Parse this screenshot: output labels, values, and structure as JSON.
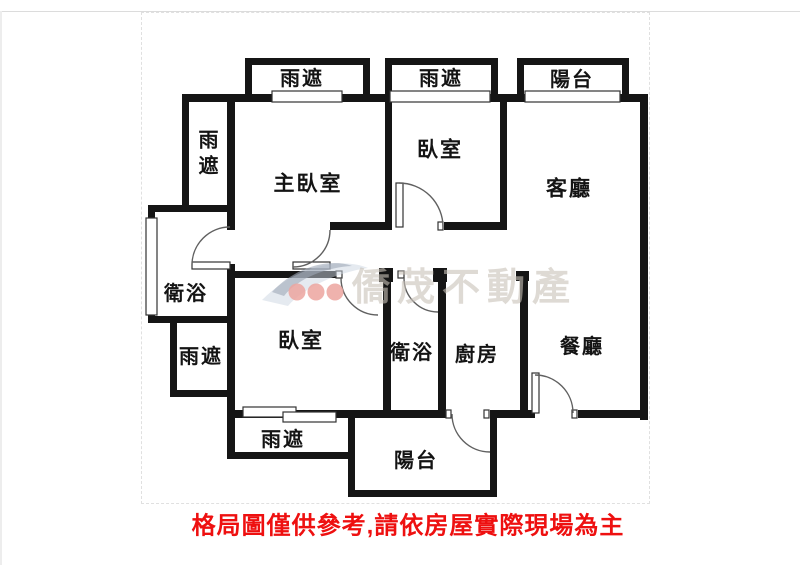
{
  "rooms": {
    "canopy_top_left": {
      "label": "雨遮"
    },
    "canopy_top_mid": {
      "label": "雨遮"
    },
    "balcony_top": {
      "label": "陽台"
    },
    "canopy_left_upper": {
      "label": "雨遮"
    },
    "master_bedroom": {
      "label": "主臥室"
    },
    "bedroom_top": {
      "label": "臥室"
    },
    "living_room": {
      "label": "客廳"
    },
    "bathroom_left": {
      "label": "衛浴"
    },
    "canopy_left_lower": {
      "label": "雨遮"
    },
    "bedroom_center": {
      "label": "臥室"
    },
    "bathroom_center": {
      "label": "衛浴"
    },
    "kitchen": {
      "label": "廚房"
    },
    "dining_room": {
      "label": "餐廳"
    },
    "canopy_bottom": {
      "label": "雨遮"
    },
    "balcony_bottom": {
      "label": "陽台"
    }
  },
  "watermark": {
    "brand": "僑茂不動產"
  },
  "disclaimer": {
    "text": "格局圖僅供參考,請依房屋實際現場為主"
  },
  "colors": {
    "wall": "#151515",
    "disclaimer_red": "#ee1010",
    "watermark_gray": "#c9c2b9",
    "logo_dot_red": "#eca49f",
    "logo_swoosh_blue": "#9fa8b8"
  }
}
